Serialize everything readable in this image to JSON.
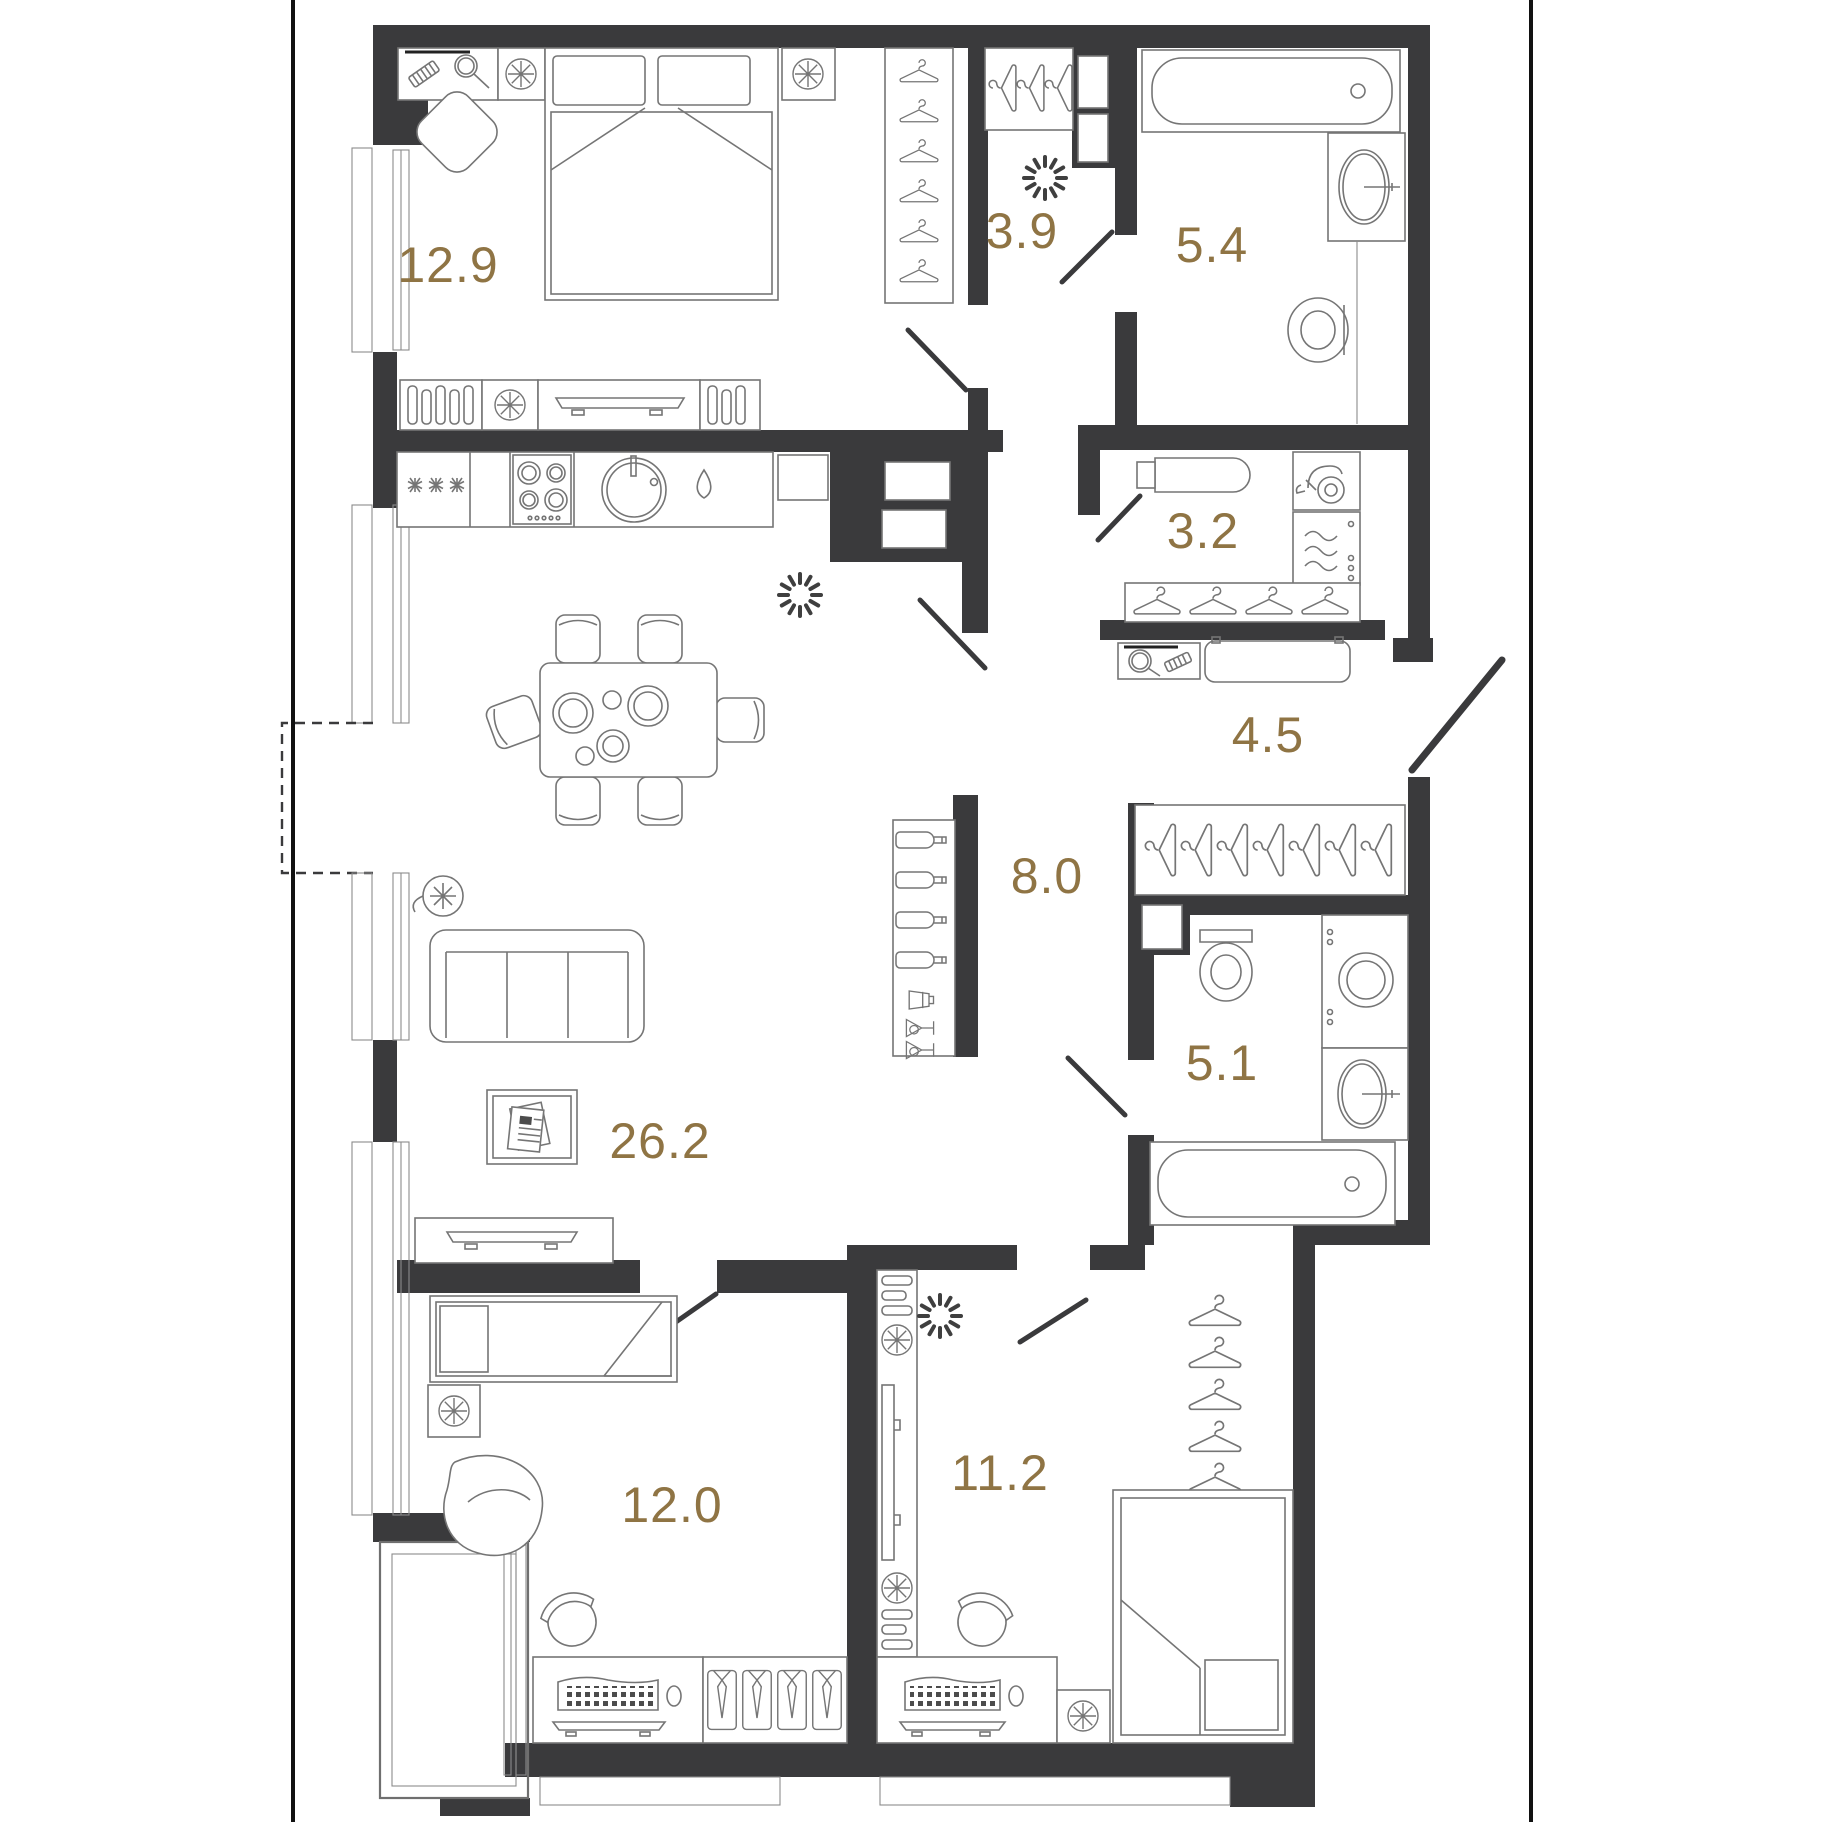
{
  "document": {
    "kind": "apartment-floor-plan",
    "units_note": "room areas as printed"
  },
  "colors": {
    "wall": "#3a3a3c",
    "furniture_line": "#757575",
    "area_label": "#8f7444",
    "frame_line": "#000000",
    "background": "#ffffff"
  },
  "rooms": [
    {
      "id": "bedroom-master",
      "area": "12.9"
    },
    {
      "id": "walkin-closet",
      "area": "3.9"
    },
    {
      "id": "bathroom-master",
      "area": "5.4"
    },
    {
      "id": "laundry-room",
      "area": "3.2"
    },
    {
      "id": "entry-hallway",
      "area": "4.5"
    },
    {
      "id": "hall",
      "area": "8.0"
    },
    {
      "id": "bathroom-second",
      "area": "5.1"
    },
    {
      "id": "living-kitchen",
      "area": "26.2"
    },
    {
      "id": "bedroom-second",
      "area": "12.0"
    },
    {
      "id": "bedroom-third",
      "area": "11.2"
    }
  ]
}
